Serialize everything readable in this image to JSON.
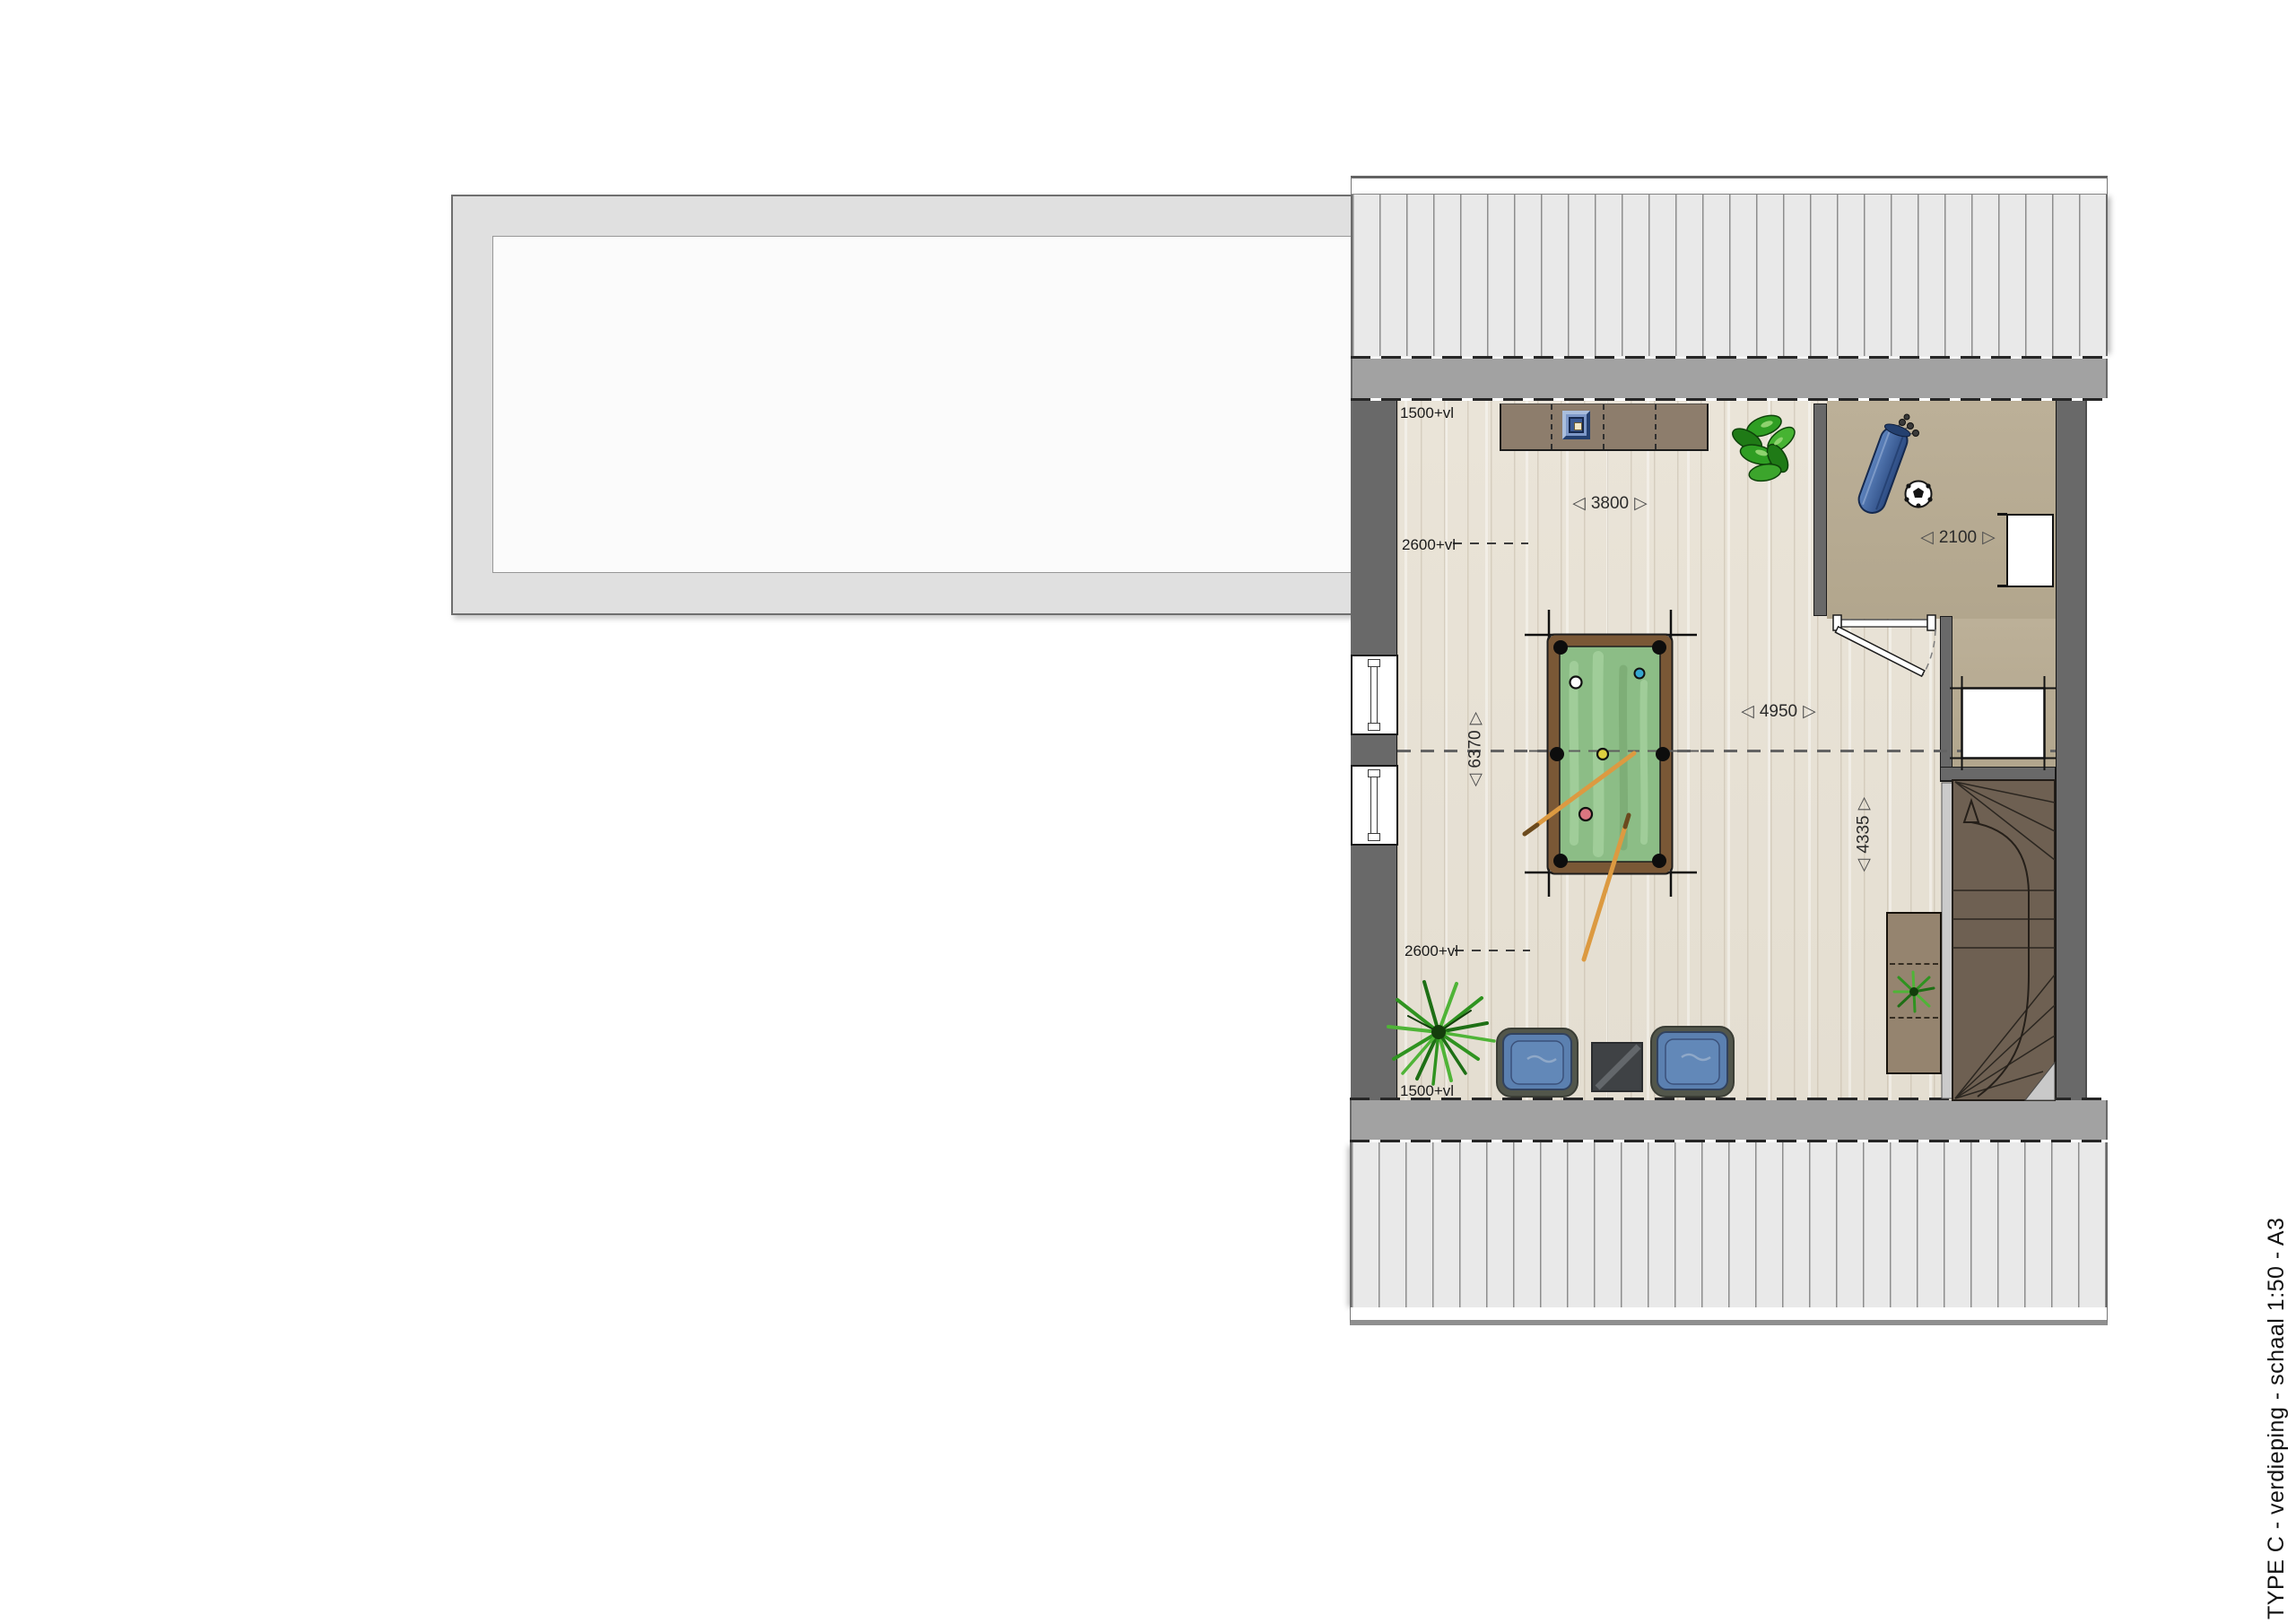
{
  "drawing": {
    "title": "TYPE C - verdieping - schaal 1:50 - A3"
  },
  "labels": {
    "top_1500": "1500+vl",
    "top_2600": "2600+vl",
    "bottom_2600": "2600+vl",
    "bottom_1500": "1500+vl"
  },
  "dimensions": {
    "room_width": "3800",
    "storage_width": "2100",
    "mid_width": "4950",
    "room_depth": "6370",
    "stair_depth": "4335"
  },
  "icons": {
    "dim_arrow_left": "◁",
    "dim_arrow_right": "▷",
    "dim_arrow_up": "▷",
    "dim_arrow_down": "◁"
  },
  "colors": {
    "wall": "#696969",
    "roof_band": "#a2a2a2",
    "roof_hatch": "#e9e9e9",
    "floor_wood": "#e8e2d6",
    "floor_storage": "#b7ab92",
    "stairs": "#6e6052",
    "furniture_wood": "#8d7d6c",
    "pool_felt": "#8cbd86",
    "pool_rail": "#7a5836",
    "chair_blue": "#5b80b0",
    "cue_orange": "#dc9a41",
    "plant_green": "#2f8f1f"
  }
}
